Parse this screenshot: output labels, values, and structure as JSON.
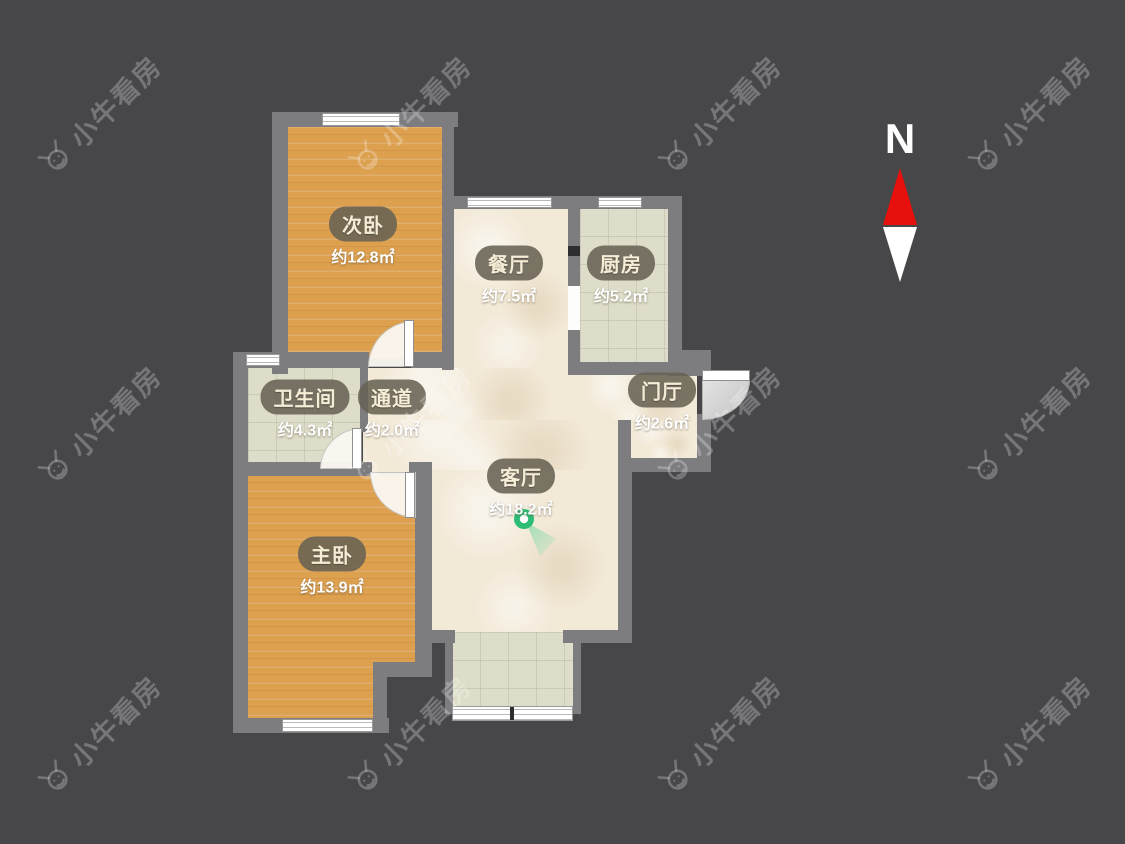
{
  "compass": {
    "label": "N"
  },
  "watermark": {
    "text": "小牛看房"
  },
  "rooms": [
    {
      "id": "secondary-bedroom",
      "name": "次卧",
      "area": "约12.8㎡"
    },
    {
      "id": "dining-room",
      "name": "餐厅",
      "area": "约7.5㎡"
    },
    {
      "id": "kitchen",
      "name": "厨房",
      "area": "约5.2㎡"
    },
    {
      "id": "bathroom",
      "name": "卫生间",
      "area": "约4.3㎡"
    },
    {
      "id": "corridor",
      "name": "通道",
      "area": "约2.0㎡"
    },
    {
      "id": "entry-hall",
      "name": "门厅",
      "area": "约2.6㎡"
    },
    {
      "id": "living-room",
      "name": "客厅",
      "area": "约18.2㎡"
    },
    {
      "id": "master-bedroom",
      "name": "主卧",
      "area": "约13.9㎡"
    }
  ],
  "colors": {
    "background": "#474749",
    "wall": "#7d7d80",
    "wood_floor": "#dda04f",
    "cream_floor": "#f2e9d7",
    "tile_floor": "#deddc9",
    "north_arrow_red": "#e8100c",
    "marker_green": "#2ebd76",
    "label_pill": "#686254",
    "label_text": "#f6edd7"
  }
}
